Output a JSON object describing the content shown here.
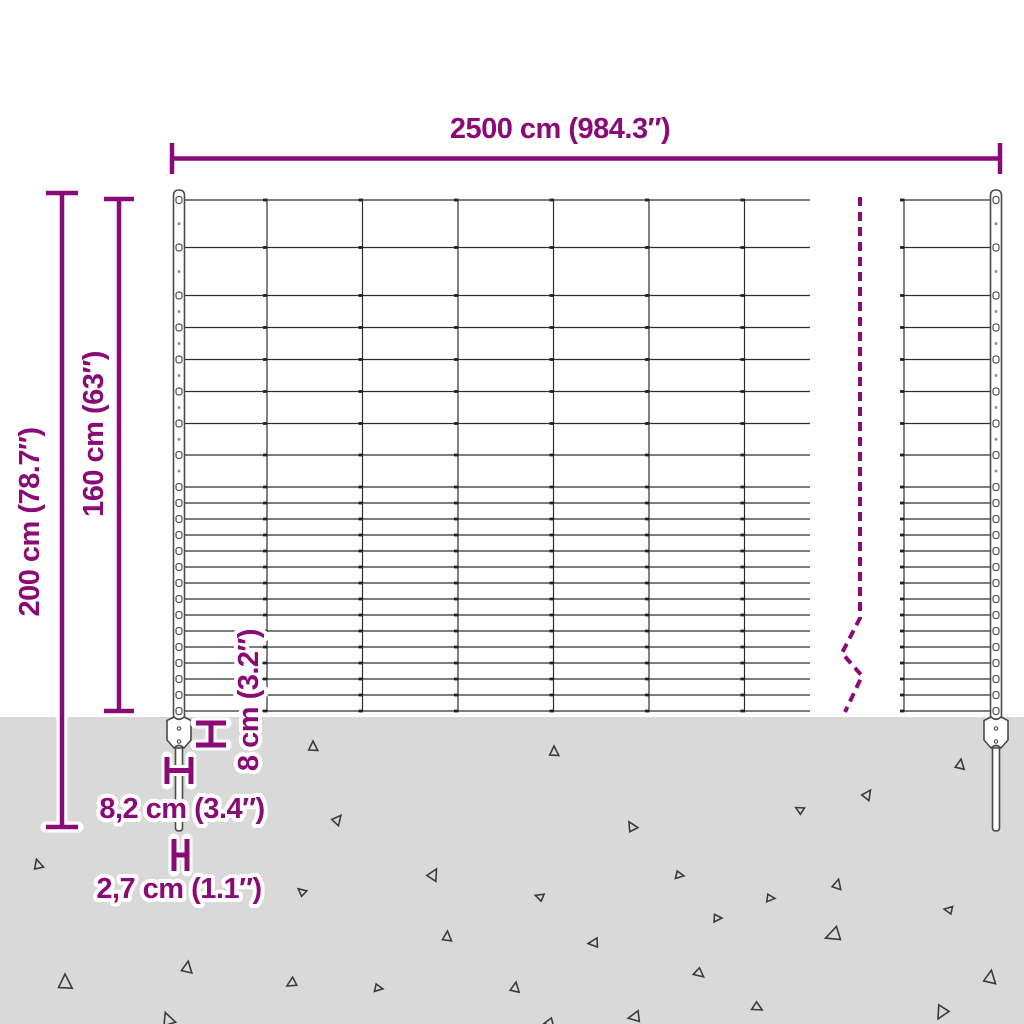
{
  "colors": {
    "accent": "#8A0A76",
    "wire": "#2e2e2e",
    "ground": "#D9D9D9",
    "post_outline": "#4a4a4a",
    "triangle_outline": "#3c3c3c",
    "background": "#ffffff"
  },
  "labels": {
    "total_width": "2500 cm (984.3″)",
    "total_height": "200 cm (78.7″)",
    "mesh_height": "160 cm (63″)",
    "plate_height": "8 cm (3.2″)",
    "plate_width": "8,2 cm (3.4″)",
    "spike_width": "2,7 cm (1.1″)"
  },
  "figure": {
    "ground_y": 717,
    "wire_ys": [
      200,
      247.5,
      295.5,
      327.5,
      359.5,
      391.5,
      423.5,
      455,
      487,
      503,
      519,
      535,
      551,
      567,
      583,
      599,
      615,
      631,
      647,
      663,
      679,
      695,
      711
    ],
    "left_mesh": {
      "x1": 173,
      "x2": 810,
      "vertical_xs": [
        267,
        362.5,
        458,
        553.5,
        649,
        744.5
      ]
    },
    "right_mesh": {
      "x1": 904,
      "x2": 1001,
      "vertical_xs": [
        904
      ]
    },
    "posts": [
      {
        "cx": 179
      },
      {
        "cx": 996
      }
    ],
    "post_top_y": 190,
    "break_line": {
      "points": "860,197 860,618 842,653 862,676 845,712"
    },
    "triangles": [
      [
        313,
        747,
        6,
        0
      ],
      [
        337,
        820,
        6,
        40
      ],
      [
        38,
        865,
        6,
        -15
      ],
      [
        433,
        875,
        7,
        30
      ],
      [
        302,
        892,
        5,
        -50
      ],
      [
        447,
        937,
        6,
        5
      ],
      [
        187,
        968,
        7,
        10
      ],
      [
        65,
        983,
        9,
        0
      ],
      [
        292,
        983,
        6,
        -120
      ],
      [
        378,
        988,
        5,
        100
      ],
      [
        168,
        1020,
        8,
        -20
      ],
      [
        554,
        752,
        6,
        0
      ],
      [
        960,
        765,
        6,
        10
      ],
      [
        867,
        795,
        6,
        35
      ],
      [
        800,
        810,
        5,
        -60
      ],
      [
        632,
        827,
        6,
        -30
      ],
      [
        679,
        875,
        5,
        100
      ],
      [
        837,
        885,
        6,
        15
      ],
      [
        540,
        897,
        5,
        -70
      ],
      [
        770,
        898,
        5,
        95
      ],
      [
        949,
        910,
        5,
        -80
      ],
      [
        717,
        918,
        5,
        90
      ],
      [
        834,
        935,
        9,
        -110
      ],
      [
        594,
        943,
        6,
        -95
      ],
      [
        699,
        973,
        6,
        130
      ],
      [
        990,
        978,
        8,
        10
      ],
      [
        515,
        988,
        6,
        10
      ],
      [
        757,
        1007,
        6,
        120
      ],
      [
        942,
        1012,
        8,
        -150
      ],
      [
        635,
        1017,
        7,
        -100
      ],
      [
        550,
        1023,
        6,
        140
      ]
    ]
  }
}
